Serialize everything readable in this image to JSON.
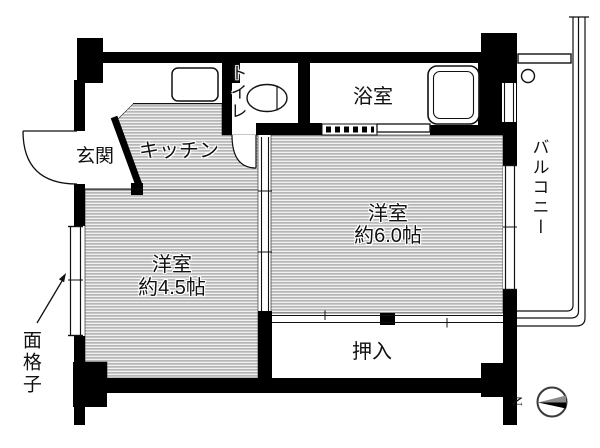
{
  "floorplan": {
    "rooms": {
      "entrance": {
        "label": "玄関"
      },
      "kitchen": {
        "label": "キッチン"
      },
      "toilet": {
        "label": "トイレ"
      },
      "bathroom": {
        "label": "浴室"
      },
      "bedroom_large": {
        "label": "洋室",
        "size": "約6.0帖"
      },
      "bedroom_small": {
        "label": "洋室",
        "size": "約4.5帖"
      },
      "closet": {
        "label": "押入"
      },
      "balcony": {
        "label": "バルコニー"
      }
    },
    "annotations": {
      "window_grate": "面格子",
      "compass_north": "N"
    },
    "colors": {
      "wall": "#000000",
      "floor_hatch_line": "#969696",
      "background": "#ffffff"
    }
  }
}
